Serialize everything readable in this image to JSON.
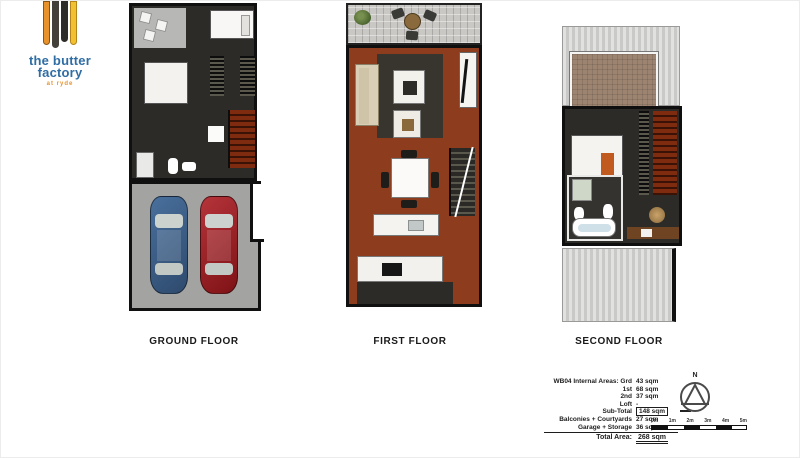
{
  "logo": {
    "title_line1": "the butter",
    "title_line2": "factory",
    "subtitle": "at ryde",
    "colors": {
      "orange": "#e8922e",
      "yellow": "#f2c12f",
      "blue": "#2f6da4",
      "dark": "#43403a"
    }
  },
  "floors": [
    {
      "label": "GROUND FLOOR",
      "features": [
        "entry",
        "bedroom",
        "bathroom",
        "stairs",
        "double garage with blue car and red car"
      ]
    },
    {
      "label": "FIRST FLOOR",
      "features": [
        "terrace",
        "living room with sofa and rug",
        "tv unit",
        "dining table",
        "kitchen island",
        "kitchen",
        "stairs"
      ]
    },
    {
      "label": "SECOND FLOOR",
      "features": [
        "roof",
        "balcony with plants",
        "bedroom",
        "bathroom with bathtub",
        "study desk",
        "stairs",
        "roof"
      ]
    }
  ],
  "area_table": {
    "rows": [
      {
        "label": "WB04 Internal Areas: Grd",
        "value": "43 sqm"
      },
      {
        "label": "1st",
        "value": "68 sqm"
      },
      {
        "label": "2nd",
        "value": "37 sqm"
      },
      {
        "label": "Loft",
        "value": "-"
      },
      {
        "label": "Sub-Total",
        "value": "148 sqm"
      },
      {
        "label": "Balconies + Courtyards",
        "value": "27 sqm"
      },
      {
        "label": "Garage + Storage",
        "value": "36 sqm"
      },
      {
        "label": "Total Area:",
        "value": "268 sqm"
      }
    ]
  },
  "compass": {
    "label": "N"
  },
  "scale_bar": {
    "labels": [
      "0m",
      "1m",
      "2m",
      "3m",
      "4m",
      "5m"
    ]
  }
}
